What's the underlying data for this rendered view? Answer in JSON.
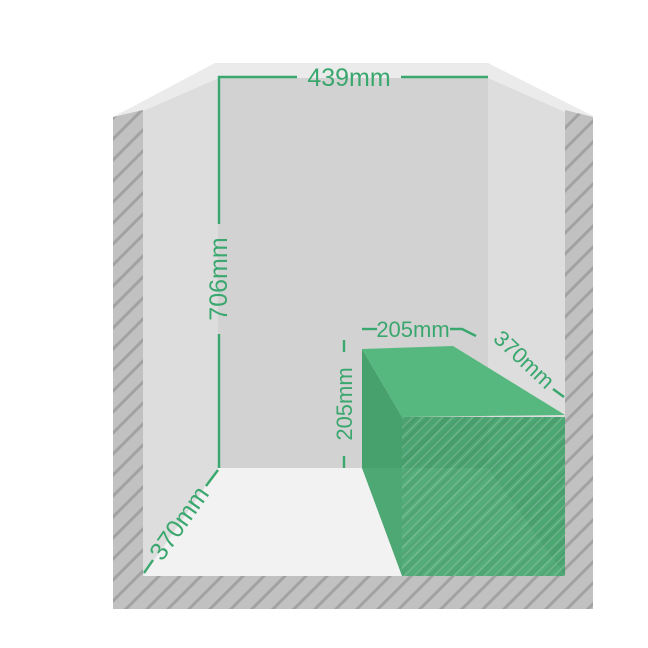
{
  "diagram": {
    "room": {
      "width_label": "439mm",
      "height_label": "706mm",
      "depth_label": "370mm"
    },
    "box": {
      "width_label": "205mm",
      "height_label": "205mm",
      "depth_label": "370mm"
    },
    "colors": {
      "dimension_green": "#3aa76e",
      "back_wall": "#d2d2d2",
      "side_wall": "#dcdddc",
      "ceiling": "#ebebeb",
      "floor": "#f2f2f2",
      "hatch_base": "#c1c1c1",
      "hatch_stripe": "#a2a2a2",
      "box_top": "#56b87e",
      "box_side": "rgba(32,148,80,0.78)",
      "box_front": "rgba(30,148,80,0.75)"
    }
  }
}
